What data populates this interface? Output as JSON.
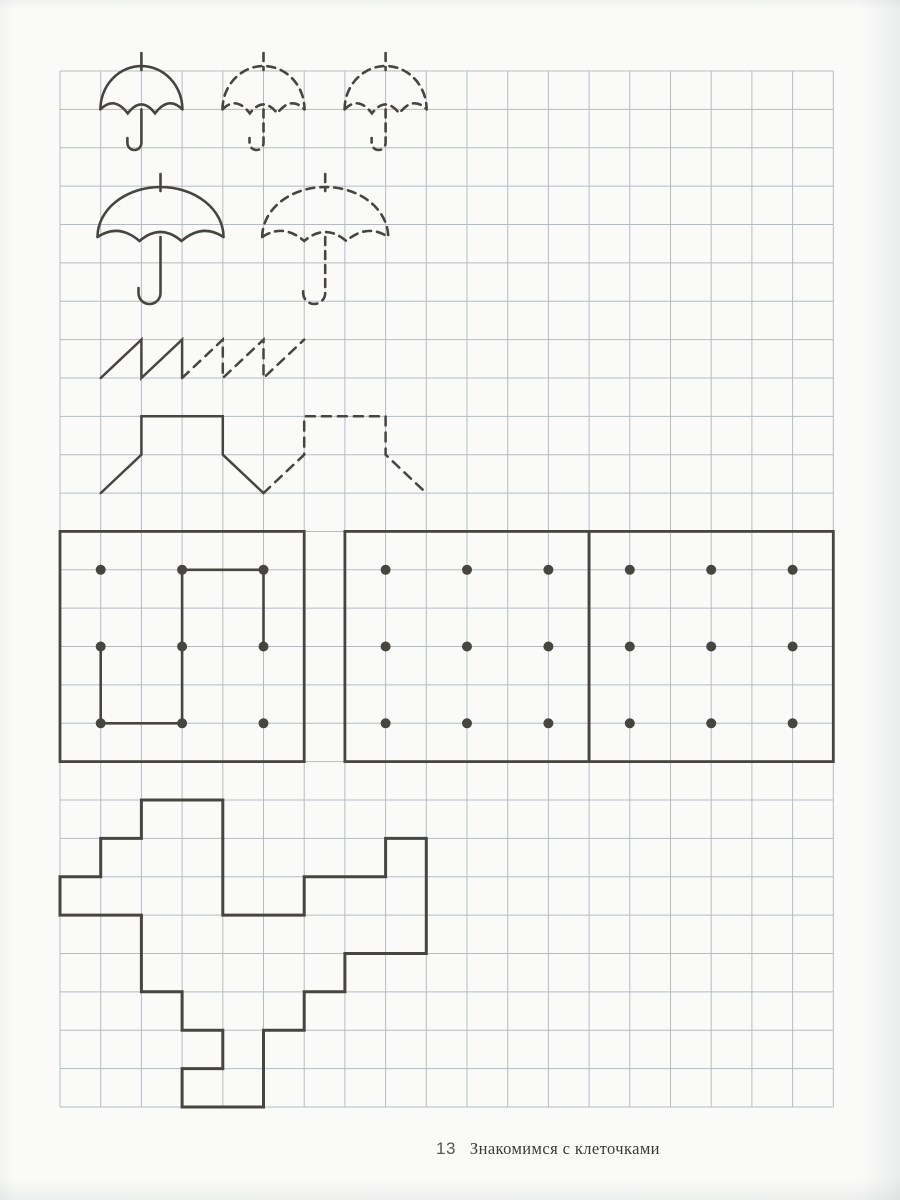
{
  "footer": {
    "page_number": "13",
    "title": "Знакомимся с клеточками"
  },
  "colors": {
    "paper": "#fafbf9",
    "grid_line": "#a8b2b9",
    "ink": "#47453f"
  },
  "grid": {
    "x0": 60,
    "y0": 71,
    "cols": 19,
    "rows": 27,
    "cell_w": 40.7,
    "cell_h": 38.37
  },
  "figures": [
    {
      "type": "umbrella",
      "name": "umbrella-small-solid",
      "cx": 141.4,
      "base": 109.4,
      "half_w": 41,
      "top": 66,
      "tick": 13,
      "stem_end": 150,
      "hook_r": 7,
      "dash": false
    },
    {
      "type": "umbrella",
      "name": "umbrella-small-traced-1",
      "cx": 263.5,
      "base": 109.4,
      "half_w": 41,
      "top": 66,
      "tick": 13,
      "stem_end": 150,
      "hook_r": 7,
      "dash": true
    },
    {
      "type": "umbrella",
      "name": "umbrella-small-traced-2",
      "cx": 385.6,
      "base": 109.4,
      "half_w": 41,
      "top": 66,
      "tick": 13,
      "stem_end": 150,
      "hook_r": 7,
      "dash": true
    },
    {
      "type": "umbrella",
      "name": "umbrella-large-solid",
      "cx": 160.5,
      "base": 237,
      "half_w": 63,
      "top": 187,
      "tick": 13,
      "stem_end": 304,
      "hook_r": 11,
      "dash": false
    },
    {
      "type": "umbrella",
      "name": "umbrella-large-traced",
      "cx": 325.2,
      "base": 237,
      "half_w": 63,
      "top": 187,
      "tick": 13,
      "stem_end": 304,
      "hook_r": 11,
      "dash": true
    },
    {
      "type": "polyline",
      "name": "zigzag-solid",
      "dash": false,
      "points": [
        [
          100.7,
          378
        ],
        [
          141.4,
          339.6
        ],
        [
          141.4,
          378
        ],
        [
          182.1,
          339.6
        ],
        [
          182.1,
          378
        ]
      ]
    },
    {
      "type": "polyline",
      "name": "zigzag-traced",
      "dash": true,
      "points": [
        [
          182.1,
          378
        ],
        [
          222.8,
          339.6
        ],
        [
          222.8,
          378
        ],
        [
          263.5,
          339.6
        ],
        [
          263.5,
          378
        ],
        [
          304.2,
          339.6
        ]
      ]
    },
    {
      "type": "polyline",
      "name": "hat-shape-solid",
      "dash": false,
      "points": [
        [
          100.7,
          493.1
        ],
        [
          141.4,
          454.7
        ],
        [
          141.4,
          416.3
        ],
        [
          222.8,
          416.3
        ],
        [
          222.8,
          454.7
        ],
        [
          263.5,
          493.1
        ]
      ]
    },
    {
      "type": "polyline",
      "name": "hat-shape-traced",
      "dash": true,
      "points": [
        [
          263.5,
          493.1
        ],
        [
          304.2,
          454.7
        ],
        [
          304.2,
          416.3
        ],
        [
          385.6,
          416.3
        ],
        [
          385.6,
          454.7
        ],
        [
          426.3,
          493.1
        ]
      ]
    },
    {
      "type": "dotbox",
      "name": "dot-box-1",
      "x": 60,
      "y": 531.4,
      "w": 244.2,
      "h": 230.2,
      "dots": [
        [
          100.7,
          569.8
        ],
        [
          182.1,
          569.8
        ],
        [
          263.5,
          569.8
        ],
        [
          100.7,
          646.5
        ],
        [
          182.1,
          646.5
        ],
        [
          263.5,
          646.5
        ],
        [
          100.7,
          723.3
        ],
        [
          182.1,
          723.3
        ],
        [
          263.5,
          723.3
        ]
      ],
      "path": [
        [
          100.7,
          646.5
        ],
        [
          100.7,
          723.3
        ],
        [
          182.1,
          723.3
        ],
        [
          182.1,
          569.8
        ],
        [
          263.5,
          569.8
        ],
        [
          263.5,
          646.5
        ]
      ]
    },
    {
      "type": "dotbox",
      "name": "dot-box-2",
      "x": 344.9,
      "y": 531.4,
      "w": 244.2,
      "h": 230.2,
      "dots": [
        [
          385.6,
          569.8
        ],
        [
          467,
          569.8
        ],
        [
          548.4,
          569.8
        ],
        [
          385.6,
          646.5
        ],
        [
          467,
          646.5
        ],
        [
          548.4,
          646.5
        ],
        [
          385.6,
          723.3
        ],
        [
          467,
          723.3
        ],
        [
          548.4,
          723.3
        ]
      ],
      "path": null
    },
    {
      "type": "dotbox",
      "name": "dot-box-3",
      "x": 589.1,
      "y": 531.4,
      "w": 244.2,
      "h": 230.2,
      "dots": [
        [
          629.8,
          569.8
        ],
        [
          711.2,
          569.8
        ],
        [
          792.6,
          569.8
        ],
        [
          629.8,
          646.5
        ],
        [
          711.2,
          646.5
        ],
        [
          792.6,
          646.5
        ],
        [
          629.8,
          723.3
        ],
        [
          711.2,
          723.3
        ],
        [
          792.6,
          723.3
        ]
      ],
      "path": null
    },
    {
      "type": "polygon",
      "name": "pixel-figure",
      "points": [
        [
          141.4,
          800
        ],
        [
          222.8,
          800
        ],
        [
          222.8,
          915.1
        ],
        [
          304.2,
          915.1
        ],
        [
          304.2,
          876.7
        ],
        [
          385.6,
          876.7
        ],
        [
          385.6,
          838.4
        ],
        [
          426.3,
          838.4
        ],
        [
          426.3,
          953.5
        ],
        [
          344.9,
          953.5
        ],
        [
          344.9,
          991.8
        ],
        [
          304.2,
          991.8
        ],
        [
          304.2,
          1030.2
        ],
        [
          263.5,
          1030.2
        ],
        [
          263.5,
          1107
        ],
        [
          182.1,
          1107
        ],
        [
          182.1,
          1068.6
        ],
        [
          222.8,
          1068.6
        ],
        [
          222.8,
          1030.2
        ],
        [
          182.1,
          1030.2
        ],
        [
          182.1,
          991.8
        ],
        [
          141.4,
          991.8
        ],
        [
          141.4,
          915.1
        ],
        [
          60,
          915.1
        ],
        [
          60,
          876.7
        ],
        [
          100.7,
          876.7
        ],
        [
          100.7,
          838.4
        ],
        [
          141.4,
          838.4
        ]
      ]
    }
  ]
}
